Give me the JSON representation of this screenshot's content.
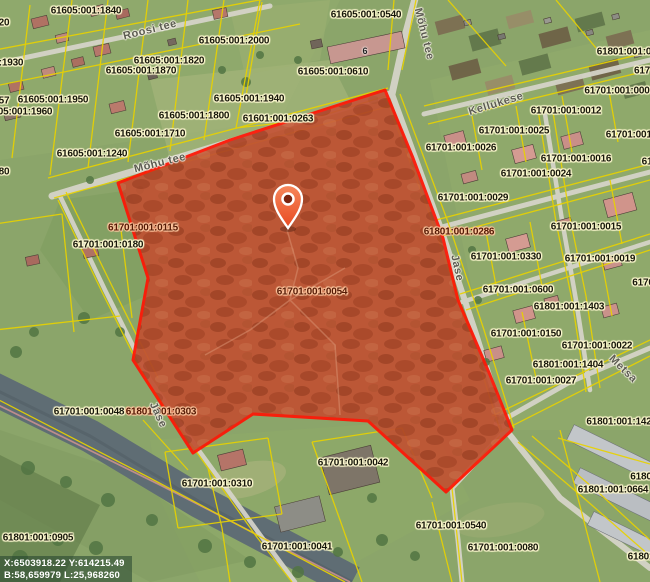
{
  "map": {
    "coordinate_readout": {
      "line1": "X:6503918.22 Y:614215.49",
      "line2": "B:58,659979 L:25,968260"
    },
    "selected_parcel": {
      "cadastral_number": "61701:001:0054"
    },
    "colors": {
      "cadastral_line": "#e8d200",
      "selected_outline": "#ff1505",
      "selected_fill": "#c2573a",
      "pin_fill": "#ef5a2b",
      "label_halo": "#fdf8cf"
    },
    "house_numbers": [
      {
        "text": "6",
        "x": 365,
        "y": 51
      }
    ],
    "street_labels": [
      {
        "text": "Roosi tee",
        "x": 150,
        "y": 30,
        "rot": -14
      },
      {
        "text": "Mõhu tee",
        "x": 424,
        "y": 34,
        "rot": 76
      },
      {
        "text": "Mõhu tee",
        "x": 160,
        "y": 163,
        "rot": -14
      },
      {
        "text": "Kellukese",
        "x": 496,
        "y": 104,
        "rot": -17
      },
      {
        "text": "Jase",
        "x": 457,
        "y": 268,
        "rot": 78
      },
      {
        "text": "Jase",
        "x": 158,
        "y": 415,
        "rot": 65
      },
      {
        "text": "Metsa",
        "x": 623,
        "y": 369,
        "rot": 44
      }
    ],
    "parcel_labels": [
      {
        "text": "20",
        "x": 4,
        "y": 23
      },
      {
        "text": "61605:001:1840",
        "x": 86,
        "y": 11
      },
      {
        "text": "61605:001:0540",
        "x": 366,
        "y": 15
      },
      {
        "text": "61605:001:2000",
        "x": 234,
        "y": 41
      },
      {
        "text": "61605:001:1930",
        "x": -12,
        "y": 63
      },
      {
        "text": "61605:001:1820",
        "x": 169,
        "y": 61
      },
      {
        "text": "61605:001:1870",
        "x": 141,
        "y": 71
      },
      {
        "text": "61605:001:0610",
        "x": 333,
        "y": 72
      },
      {
        "text": "57",
        "x": 4,
        "y": 101
      },
      {
        "text": "61605:001:1950",
        "x": 53,
        "y": 100
      },
      {
        "text": "61605:001:1960",
        "x": 17,
        "y": 112
      },
      {
        "text": "61605:001:1940",
        "x": 249,
        "y": 99
      },
      {
        "text": "61605:001:1800",
        "x": 194,
        "y": 116
      },
      {
        "text": "61601:001:0263",
        "x": 278,
        "y": 119
      },
      {
        "text": "61605:001:1710",
        "x": 150,
        "y": 134
      },
      {
        "text": "61605:001:1240",
        "x": 92,
        "y": 154
      },
      {
        "text": "80",
        "x": 4,
        "y": 172
      },
      {
        "text": "61701:001:0115",
        "x": 143,
        "y": 228,
        "tint": true
      },
      {
        "text": "61701:001:0180",
        "x": 108,
        "y": 245
      },
      {
        "text": "61701:001:0054",
        "x": 312,
        "y": 292,
        "tint": true
      },
      {
        "text": "61801:001:0286",
        "x": 459,
        "y": 232,
        "tint": true
      },
      {
        "text": "61801:001:0",
        "x": 624,
        "y": 52
      },
      {
        "text": "617",
        "x": 642,
        "y": 71
      },
      {
        "text": "61701:001:000",
        "x": 617,
        "y": 91
      },
      {
        "text": "61701:001:0012",
        "x": 566,
        "y": 111
      },
      {
        "text": "61701:001:0025",
        "x": 514,
        "y": 131
      },
      {
        "text": "61701:001:0",
        "x": 633,
        "y": 135
      },
      {
        "text": "61701:001:0026",
        "x": 461,
        "y": 148
      },
      {
        "text": "61",
        "x": 647,
        "y": 162
      },
      {
        "text": "61701:001:0016",
        "x": 576,
        "y": 159
      },
      {
        "text": "61701:001:0024",
        "x": 536,
        "y": 174
      },
      {
        "text": "61701:001:0029",
        "x": 473,
        "y": 198
      },
      {
        "text": "61701:001:0015",
        "x": 586,
        "y": 227
      },
      {
        "text": "61701:001:0330",
        "x": 506,
        "y": 257
      },
      {
        "text": "61701:001:0019",
        "x": 600,
        "y": 259
      },
      {
        "text": "6170",
        "x": 643,
        "y": 283
      },
      {
        "text": "61701:001:0600",
        "x": 518,
        "y": 290
      },
      {
        "text": "61801:001:1403",
        "x": 569,
        "y": 307
      },
      {
        "text": "61701:001:0150",
        "x": 526,
        "y": 334
      },
      {
        "text": "61701:001:0022",
        "x": 597,
        "y": 346
      },
      {
        "text": "61801:001:1404",
        "x": 568,
        "y": 365
      },
      {
        "text": "61701:001:0027",
        "x": 541,
        "y": 381
      },
      {
        "text": "61701:001:0048",
        "x": 89,
        "y": 412
      },
      {
        "text": "61801:001:0303",
        "x": 161,
        "y": 412,
        "tint": true
      },
      {
        "text": "61801:001:142",
        "x": 619,
        "y": 422
      },
      {
        "text": "6180",
        "x": 641,
        "y": 477
      },
      {
        "text": "61701:001:0310",
        "x": 217,
        "y": 484
      },
      {
        "text": "61801:001:0664",
        "x": 613,
        "y": 490
      },
      {
        "text": "61701:001:0540",
        "x": 451,
        "y": 526
      },
      {
        "text": "61801:001:0905",
        "x": 38,
        "y": 538
      },
      {
        "text": "61701:001:0041",
        "x": 297,
        "y": 547
      },
      {
        "text": "61701:001:0042",
        "x": 353,
        "y": 463
      },
      {
        "text": "61701:001:0080",
        "x": 503,
        "y": 548
      },
      {
        "text": "61801",
        "x": 641,
        "y": 557
      }
    ]
  }
}
